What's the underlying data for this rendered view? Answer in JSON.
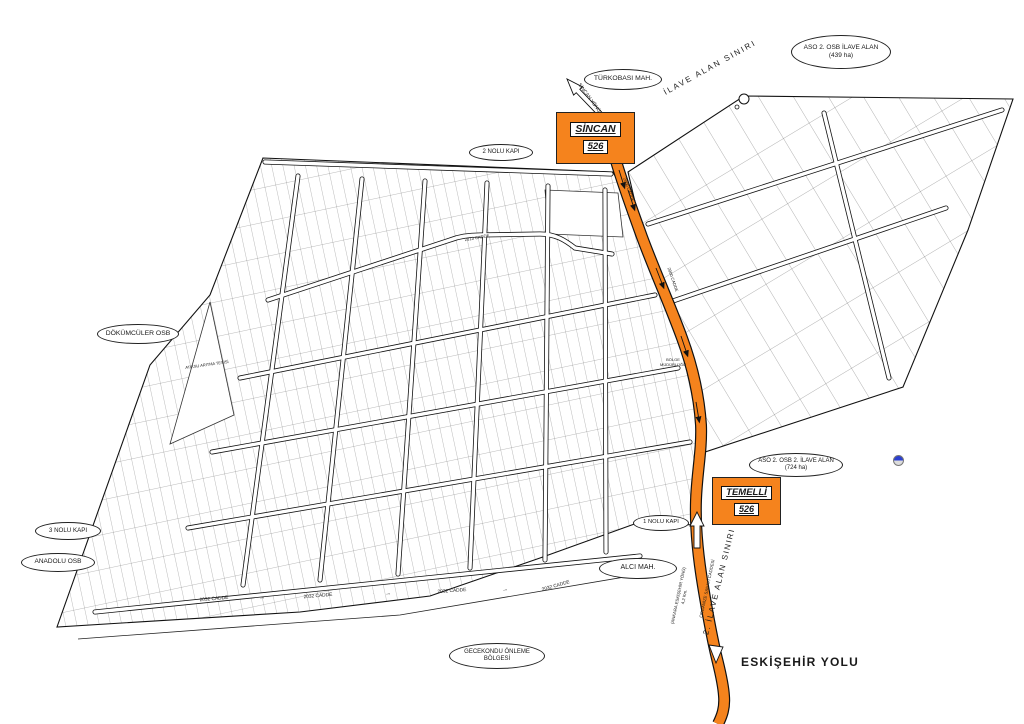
{
  "colors": {
    "highlight_orange": "#F5831D",
    "map_line": "#1a1a1a",
    "marker_blue": "#2b3fd0"
  },
  "ellipses": {
    "aso_ilave_1": {
      "line1": "ASO 2. OSB İLAVE ALAN",
      "line2": "(439 ha)"
    },
    "turkobasi_mah": {
      "line1": "TÜRKOBASI MAH."
    },
    "kapi_2": {
      "line1": "2 NOLU KAPI"
    },
    "dokumculer_osb": {
      "line1": "DÖKÜMCÜLER OSB"
    },
    "kapi_3": {
      "line1": "3 NOLU KAPI"
    },
    "anadolu_osb": {
      "line1": "ANADOLU OSB"
    },
    "gecekondu": {
      "line1": "GECEKONDU ÖNLEME",
      "line2": "BÖLGESİ"
    },
    "alci_mah": {
      "line1": "ALCI MAH."
    },
    "kapi_1": {
      "line1": "1 NOLU KAPI"
    },
    "aso_ilave_2": {
      "line1": "ASO 2. OSB 2. İLAVE ALAN",
      "line2": "(724 ha)"
    }
  },
  "route_boxes": {
    "sincan": {
      "name": "SİNCAN",
      "number": "526"
    },
    "temelli": {
      "name": "TEMELLİ",
      "number": "526"
    }
  },
  "boundary_labels": {
    "ilave_alan_siniri": "İLAVE ALAN SINIRI",
    "ilave_alan_siniri_2": "2. İLAVE ALAN SINIRI"
  },
  "road_labels": {
    "eskisehir_yolu": "ESKİŞEHİR YOLU",
    "organize_sanayi": "ORGANİZE SANAYİ CADDESİ",
    "ankara_yonu_line1": "(ANKARA ESKİŞEHİR YÖNÜ)",
    "ankara_yonu_line2": "4,2 Km.",
    "sincan_yonu": "SİNCAN YÖNÜ",
    "cadde_2032": "2032 CADDE",
    "cadde_2013": "2013 CADDE",
    "cadde_2000": "2000 CADDE",
    "flow_arrow": "→"
  },
  "site_labels": {
    "atiksu": "ATIKSU ARITMA TESİSİ",
    "bolge_line1": "BÖLGE",
    "bolge_line2": "MÜDÜRLÜĞÜ"
  }
}
